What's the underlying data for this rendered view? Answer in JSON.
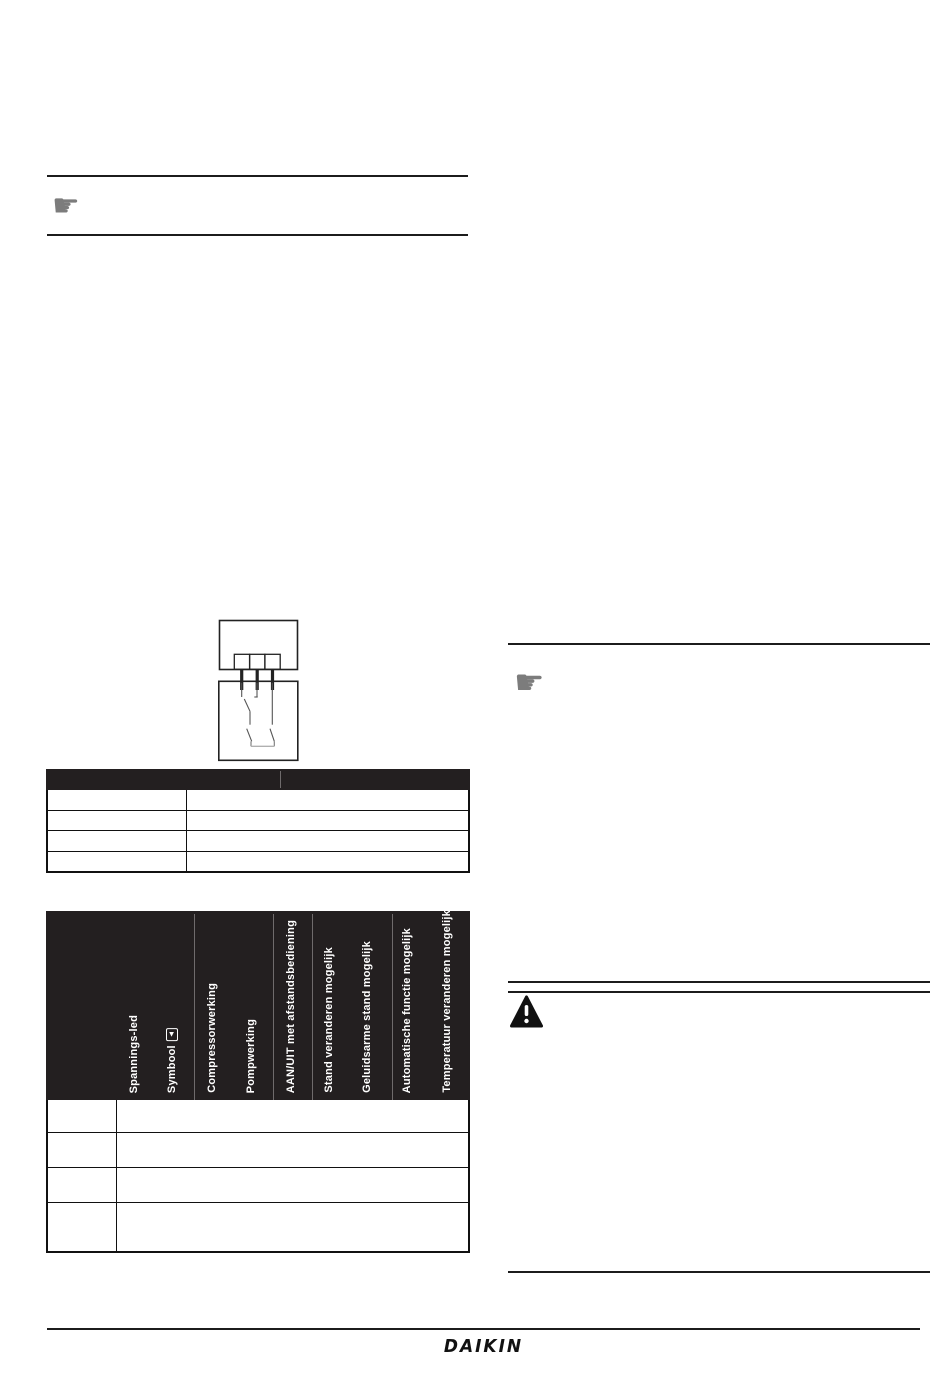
{
  "colors": {
    "table_header_bg": "#231f20",
    "rule": "#1c1c1c",
    "note_icon_gray": "#7c7c7c",
    "warning_icon": "#111111"
  },
  "icons": {
    "note_left": "pointing-hand-note",
    "note_right": "pointing-hand-note",
    "note_glyph": "☛",
    "warning": "warning-triangle"
  },
  "left_column": {
    "connection_table": {
      "header": [
        "",
        ""
      ],
      "rows": [
        [
          "",
          ""
        ],
        [
          "",
          ""
        ],
        [
          "",
          ""
        ],
        [
          "",
          ""
        ]
      ]
    },
    "status_table": {
      "corner_label": "",
      "columns": [
        "Spannings-led",
        "Symbool",
        "Compressorwerking",
        "Pompwerking",
        "AAN/UIT met afstandsbediening",
        "Stand veranderen mogelijk",
        "Geluidsarme stand mogelijk",
        "Automatische functie mogelijk",
        "Temperatuur veranderen mogelijk"
      ],
      "symbol_glyph": "▲",
      "rows": [
        [
          "",
          ""
        ],
        [
          "",
          ""
        ],
        [
          "",
          ""
        ],
        [
          "",
          ""
        ]
      ]
    }
  },
  "footer": {
    "logo_text": "DAIKIN"
  }
}
